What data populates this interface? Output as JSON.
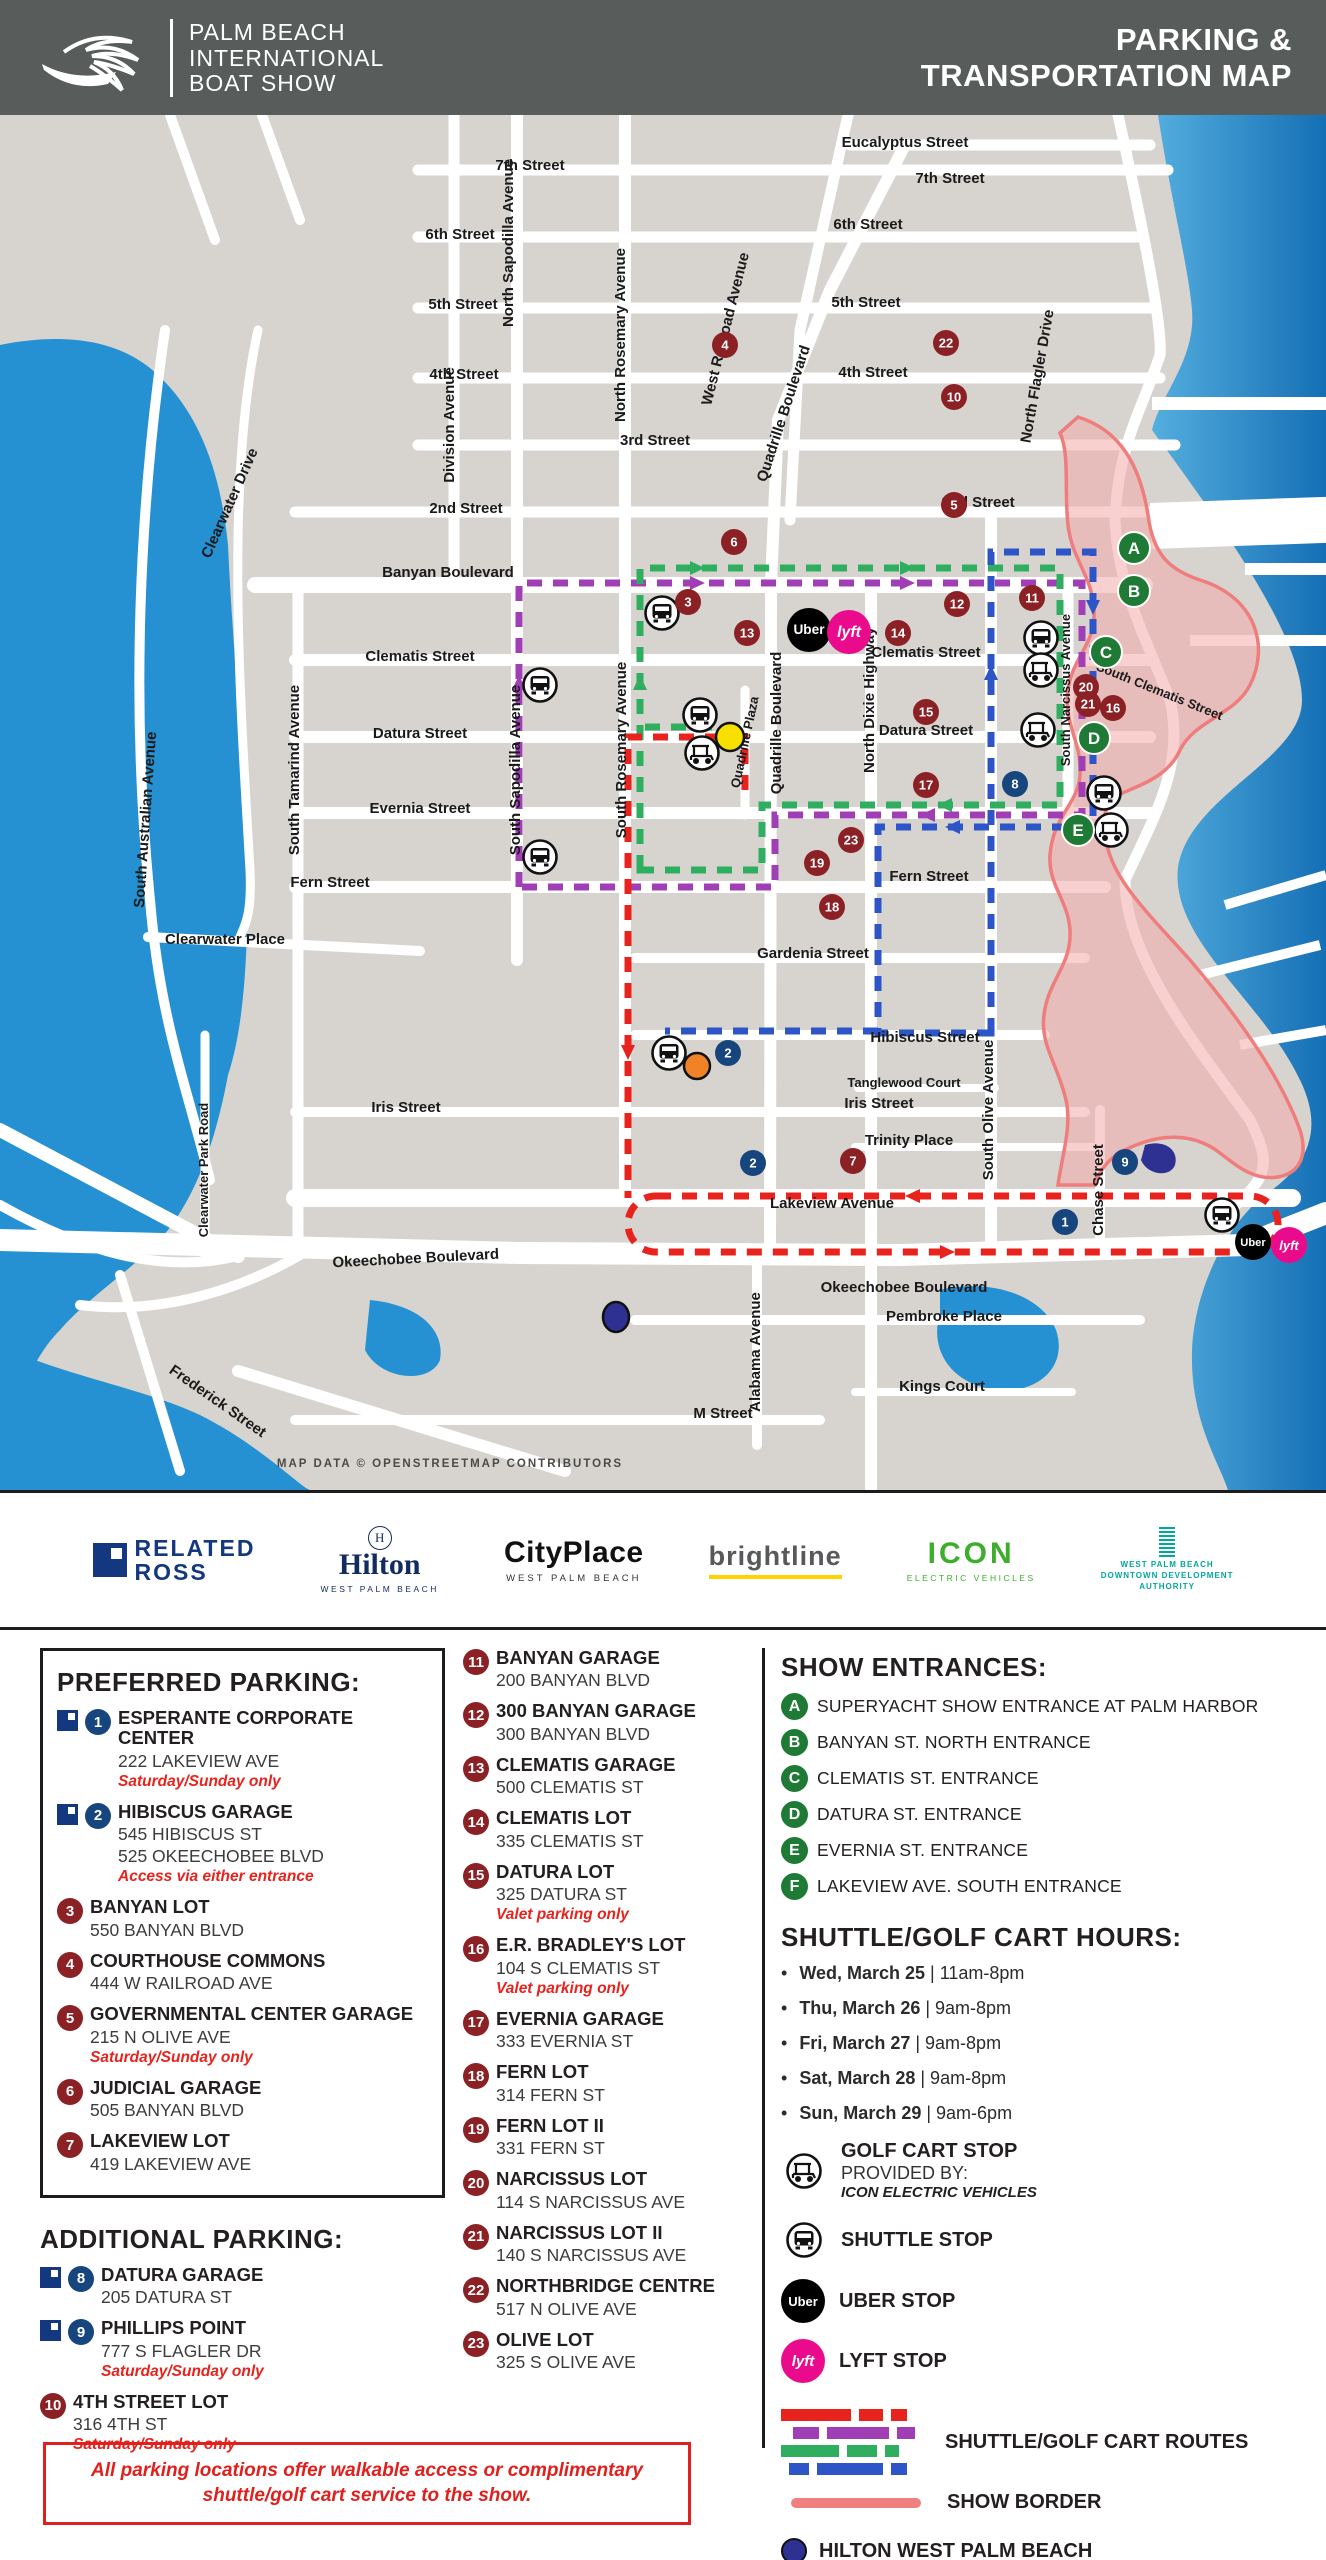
{
  "header": {
    "brand_lines": [
      "PALM BEACH",
      "INTERNATIONAL",
      "BOAT SHOW"
    ],
    "title_lines": [
      "PARKING &",
      "TRANSPORTATION MAP"
    ]
  },
  "map": {
    "attribution": "MAP DATA © OPENSTREETMAP CONTRIBUTORS",
    "street_labels": [
      {
        "t": "Eucalyptus Street",
        "x": 905,
        "y": 32
      },
      {
        "t": "7th Street",
        "x": 530,
        "y": 55
      },
      {
        "t": "7th Street",
        "x": 950,
        "y": 68
      },
      {
        "t": "6th Street",
        "x": 460,
        "y": 124
      },
      {
        "t": "6th Street",
        "x": 868,
        "y": 114
      },
      {
        "t": "5th Street",
        "x": 463,
        "y": 194
      },
      {
        "t": "5th Street",
        "x": 866,
        "y": 192
      },
      {
        "t": "4th Street",
        "x": 464,
        "y": 264
      },
      {
        "t": "4th Street",
        "x": 873,
        "y": 262
      },
      {
        "t": "3rd Street",
        "x": 655,
        "y": 330
      },
      {
        "t": "2nd Street",
        "x": 466,
        "y": 398
      },
      {
        "t": "2nd Street",
        "x": 978,
        "y": 392
      },
      {
        "t": "Banyan Boulevard",
        "x": 448,
        "y": 462
      },
      {
        "t": "Clematis Street",
        "x": 420,
        "y": 546
      },
      {
        "t": "Clematis Street",
        "x": 926,
        "y": 542
      },
      {
        "t": "Datura Street",
        "x": 420,
        "y": 623
      },
      {
        "t": "Datura Street",
        "x": 926,
        "y": 620
      },
      {
        "t": "Evernia Street",
        "x": 420,
        "y": 698
      },
      {
        "t": "Fern Street",
        "x": 330,
        "y": 772
      },
      {
        "t": "Fern Street",
        "x": 929,
        "y": 766
      },
      {
        "t": "Gardenia Street",
        "x": 813,
        "y": 843
      },
      {
        "t": "Hibiscus Street",
        "x": 925,
        "y": 927
      },
      {
        "t": "Tanglewood Court",
        "x": 904,
        "y": 972,
        "s": 13
      },
      {
        "t": "Iris Street",
        "x": 406,
        "y": 997
      },
      {
        "t": "Iris Street",
        "x": 879,
        "y": 993
      },
      {
        "t": "Trinity Place",
        "x": 909,
        "y": 1030
      },
      {
        "t": "Lakeview Avenue",
        "x": 832,
        "y": 1093
      },
      {
        "t": "Okeechobee Boulevard",
        "x": 416,
        "y": 1148,
        "r": -3
      },
      {
        "t": "Okeechobee Boulevard",
        "x": 904,
        "y": 1177
      },
      {
        "t": "Pembroke Place",
        "x": 944,
        "y": 1206
      },
      {
        "t": "Kings Court",
        "x": 942,
        "y": 1276
      },
      {
        "t": "M Street",
        "x": 723,
        "y": 1303
      },
      {
        "t": "Frederick Street",
        "x": 215,
        "y": 1290,
        "r": 35
      },
      {
        "t": "Clearwater Place",
        "x": 225,
        "y": 829
      },
      {
        "t": "North Sapodilla Avenue",
        "x": 513,
        "y": 128,
        "r": -90
      },
      {
        "t": "North Rosemary Avenue",
        "x": 625,
        "y": 220,
        "r": -90
      },
      {
        "t": "Division Avenue",
        "x": 454,
        "y": 310,
        "r": -90
      },
      {
        "t": "West Railroad Avenue",
        "x": 730,
        "y": 215,
        "r": -76
      },
      {
        "t": "Quadrille Boulevard",
        "x": 788,
        "y": 300,
        "r": -72
      },
      {
        "t": "Quadrille Boulevard",
        "x": 781,
        "y": 608,
        "r": -90
      },
      {
        "t": "Quadrille Plaza",
        "x": 749,
        "y": 628,
        "r": -78,
        "s": 13
      },
      {
        "t": "North Flagler Drive",
        "x": 1042,
        "y": 262,
        "r": -80
      },
      {
        "t": "North Dixie Highway",
        "x": 874,
        "y": 585,
        "r": -90
      },
      {
        "t": "South Olive Avenue",
        "x": 993,
        "y": 995,
        "r": -90
      },
      {
        "t": "South Narcissus Avenue",
        "x": 1070,
        "y": 575,
        "r": -90,
        "s": 13
      },
      {
        "t": "Chase Street",
        "x": 1103,
        "y": 1075,
        "r": -90
      },
      {
        "t": "Alabama Avenue",
        "x": 760,
        "y": 1237,
        "r": -90
      },
      {
        "t": "South Sapodilla Avenue",
        "x": 520,
        "y": 655,
        "r": -90
      },
      {
        "t": "South Rosemary Avenue",
        "x": 626,
        "y": 635,
        "r": -90
      },
      {
        "t": "South Tamarind Avenue",
        "x": 299,
        "y": 655,
        "r": -90
      },
      {
        "t": "South Australian Avenue",
        "x": 150,
        "y": 705,
        "r": -86
      },
      {
        "t": "Clearwater Drive",
        "x": 234,
        "y": 390,
        "r": -66
      },
      {
        "t": "Clearwater Park Road",
        "x": 208,
        "y": 1055,
        "r": -90,
        "s": 13
      },
      {
        "t": "South Clematis Street",
        "x": 1158,
        "y": 580,
        "r": 22,
        "s": 13
      }
    ],
    "parking_markers": [
      {
        "n": "1",
        "c": "blue",
        "x": 1065,
        "y": 1107
      },
      {
        "n": "2",
        "c": "blue",
        "x": 728,
        "y": 938
      },
      {
        "n": "2",
        "c": "blue",
        "x": 753,
        "y": 1048
      },
      {
        "n": "3",
        "c": "red",
        "x": 688,
        "y": 487
      },
      {
        "n": "4",
        "c": "red",
        "x": 725,
        "y": 230
      },
      {
        "n": "5",
        "c": "red",
        "x": 954,
        "y": 390
      },
      {
        "n": "6",
        "c": "red",
        "x": 734,
        "y": 427
      },
      {
        "n": "7",
        "c": "red",
        "x": 853,
        "y": 1046
      },
      {
        "n": "8",
        "c": "blue",
        "x": 1015,
        "y": 669
      },
      {
        "n": "9",
        "c": "blue",
        "x": 1125,
        "y": 1047
      },
      {
        "n": "10",
        "c": "red",
        "x": 954,
        "y": 282
      },
      {
        "n": "11",
        "c": "red",
        "x": 1032,
        "y": 483
      },
      {
        "n": "12",
        "c": "red",
        "x": 957,
        "y": 489
      },
      {
        "n": "13",
        "c": "red",
        "x": 747,
        "y": 518
      },
      {
        "n": "14",
        "c": "red",
        "x": 898,
        "y": 518
      },
      {
        "n": "15",
        "c": "red",
        "x": 926,
        "y": 597
      },
      {
        "n": "16",
        "c": "red",
        "x": 1113,
        "y": 593
      },
      {
        "n": "17",
        "c": "red",
        "x": 926,
        "y": 670
      },
      {
        "n": "18",
        "c": "red",
        "x": 832,
        "y": 792
      },
      {
        "n": "19",
        "c": "red",
        "x": 817,
        "y": 748
      },
      {
        "n": "20",
        "c": "red",
        "x": 1086,
        "y": 572
      },
      {
        "n": "21",
        "c": "red",
        "x": 1088,
        "y": 589
      },
      {
        "n": "22",
        "c": "red",
        "x": 946,
        "y": 228
      },
      {
        "n": "23",
        "c": "red",
        "x": 851,
        "y": 725
      }
    ],
    "entrance_markers": [
      {
        "l": "A",
        "x": 1134,
        "y": 433
      },
      {
        "l": "B",
        "x": 1134,
        "y": 476
      },
      {
        "l": "C",
        "x": 1106,
        "y": 537
      },
      {
        "l": "D",
        "x": 1094,
        "y": 623
      },
      {
        "l": "E",
        "x": 1078,
        "y": 715
      }
    ],
    "shuttle_stops": [
      [
        662,
        498
      ],
      [
        540,
        570
      ],
      [
        540,
        742
      ],
      [
        700,
        600
      ],
      [
        1041,
        523
      ],
      [
        1104,
        678
      ],
      [
        669,
        938
      ],
      [
        1222,
        1100
      ]
    ],
    "golfcart_stops": [
      [
        702,
        638
      ],
      [
        1041,
        555
      ],
      [
        1038,
        615
      ],
      [
        1111,
        715
      ]
    ],
    "uber_stops": [
      {
        "x": 809,
        "y": 515,
        "r": 22
      },
      {
        "x": 1253,
        "y": 1127,
        "r": 18
      }
    ],
    "lyft_stops": [
      {
        "x": 849,
        "y": 517,
        "r": 22
      },
      {
        "x": 1289,
        "y": 1130,
        "r": 18
      }
    ],
    "pois": {
      "hilton": {
        "x": 616,
        "y": 1202
      },
      "cityplace": {
        "x": 697,
        "y": 951
      },
      "brightline": {
        "x": 730,
        "y": 622
      }
    }
  },
  "sponsors": {
    "related": {
      "line1": "RELATED",
      "line2": "ROSS"
    },
    "hilton": {
      "mark": "H",
      "name": "Hilton",
      "sub": "WEST PALM BEACH"
    },
    "cityplace": {
      "name": "CityPlace",
      "sub": "WEST PALM BEACH"
    },
    "brightline": {
      "name": "brightline"
    },
    "icon": {
      "name": "ICON",
      "sub": "ELECTRIC VEHICLES"
    },
    "dda": {
      "line1": "WEST PALM BEACH",
      "line2": "DOWNTOWN DEVELOPMENT",
      "line3": "AUTHORITY"
    }
  },
  "parking": {
    "preferred_title": "PREFERRED PARKING:",
    "preferred": [
      {
        "num": "1",
        "badge": "blue",
        "rr": true,
        "name": "ESPERANTE CORPORATE CENTER",
        "addr": [
          "222 LAKEVIEW AVE"
        ],
        "note": "Saturday/Sunday only"
      },
      {
        "num": "2",
        "badge": "blue",
        "rr": true,
        "name": "HIBISCUS GARAGE",
        "addr": [
          "545 HIBISCUS ST",
          "525 OKEECHOBEE BLVD"
        ],
        "note": "Access via either entrance"
      },
      {
        "num": "3",
        "badge": "red",
        "name": "BANYAN LOT",
        "addr": [
          "550 BANYAN BLVD"
        ]
      },
      {
        "num": "4",
        "badge": "red",
        "name": "COURTHOUSE COMMONS",
        "addr": [
          "444 W RAILROAD AVE"
        ]
      },
      {
        "num": "5",
        "badge": "red",
        "name": "GOVERNMENTAL CENTER GARAGE",
        "addr": [
          "215 N OLIVE AVE"
        ],
        "note": "Saturday/Sunday only"
      },
      {
        "num": "6",
        "badge": "red",
        "name": "JUDICIAL GARAGE",
        "addr": [
          "505 BANYAN BLVD"
        ]
      },
      {
        "num": "7",
        "badge": "red",
        "name": "LAKEVIEW LOT",
        "addr": [
          "419 LAKEVIEW AVE"
        ]
      }
    ],
    "additional_title": "ADDITIONAL PARKING:",
    "additional": [
      {
        "num": "8",
        "badge": "blue",
        "rr": true,
        "name": "DATURA GARAGE",
        "addr": [
          "205 DATURA ST"
        ]
      },
      {
        "num": "9",
        "badge": "blue",
        "rr": true,
        "name": "PHILLIPS POINT",
        "addr": [
          "777 S FLAGLER DR"
        ],
        "note": "Saturday/Sunday only"
      },
      {
        "num": "10",
        "badge": "red",
        "name": "4TH STREET LOT",
        "addr": [
          "316 4TH ST"
        ],
        "note": "Saturday/Sunday only"
      }
    ],
    "column2": [
      {
        "num": "11",
        "badge": "red",
        "name": "BANYAN GARAGE",
        "addr": [
          "200 BANYAN BLVD"
        ]
      },
      {
        "num": "12",
        "badge": "red",
        "name": "300 BANYAN GARAGE",
        "addr": [
          "300 BANYAN BLVD"
        ]
      },
      {
        "num": "13",
        "badge": "red",
        "name": "CLEMATIS GARAGE",
        "addr": [
          "500 CLEMATIS ST"
        ]
      },
      {
        "num": "14",
        "badge": "red",
        "name": "CLEMATIS LOT",
        "addr": [
          "335 CLEMATIS ST"
        ]
      },
      {
        "num": "15",
        "badge": "red",
        "name": "DATURA LOT",
        "addr": [
          "325 DATURA ST"
        ],
        "note": "Valet parking only"
      },
      {
        "num": "16",
        "badge": "red",
        "name": "E.R. BRADLEY'S LOT",
        "addr": [
          "104 S CLEMATIS ST"
        ],
        "note": "Valet parking only"
      },
      {
        "num": "17",
        "badge": "red",
        "name": "EVERNIA GARAGE",
        "addr": [
          "333 EVERNIA ST"
        ]
      },
      {
        "num": "18",
        "badge": "red",
        "name": "FERN LOT",
        "addr": [
          "314 FERN ST"
        ]
      },
      {
        "num": "19",
        "badge": "red",
        "name": "FERN LOT II",
        "addr": [
          "331 FERN ST"
        ]
      },
      {
        "num": "20",
        "badge": "red",
        "name": "NARCISSUS LOT",
        "addr": [
          "114 S NARCISSUS AVE"
        ]
      },
      {
        "num": "21",
        "badge": "red",
        "name": "NARCISSUS LOT II",
        "addr": [
          "140 S NARCISSUS AVE"
        ]
      },
      {
        "num": "22",
        "badge": "red",
        "name": "NORTHBRIDGE CENTRE",
        "addr": [
          "517 N OLIVE AVE"
        ]
      },
      {
        "num": "23",
        "badge": "red",
        "name": "OLIVE LOT",
        "addr": [
          "325 S OLIVE AVE"
        ]
      }
    ]
  },
  "entrances": {
    "title": "SHOW ENTRANCES:",
    "items": [
      {
        "letter": "A",
        "label": "SUPERYACHT SHOW ENTRANCE AT PALM HARBOR"
      },
      {
        "letter": "B",
        "label": "BANYAN ST. NORTH ENTRANCE"
      },
      {
        "letter": "C",
        "label": "CLEMATIS ST. ENTRANCE"
      },
      {
        "letter": "D",
        "label": "DATURA ST. ENTRANCE"
      },
      {
        "letter": "E",
        "label": "EVERNIA ST. ENTRANCE"
      },
      {
        "letter": "F",
        "label": "LAKEVIEW AVE. SOUTH ENTRANCE"
      }
    ]
  },
  "hours": {
    "title": "SHUTTLE/GOLF CART HOURS:",
    "items": [
      {
        "day": "Wed, March 25",
        "time": "11am-8pm"
      },
      {
        "day": "Thu, March 26",
        "time": "9am-8pm"
      },
      {
        "day": "Fri, March 27",
        "time": "9am-8pm"
      },
      {
        "day": "Sat, March 28",
        "time": "9am-8pm"
      },
      {
        "day": "Sun, March 29",
        "time": "9am-6pm"
      }
    ]
  },
  "stops_legend": {
    "golfcart_line1": "GOLF CART STOP",
    "golfcart_line2": "PROVIDED BY:",
    "golfcart_line3": "ICON ELECTRIC VEHICLES",
    "shuttle": "SHUTTLE STOP",
    "uber_badge": "Uber",
    "uber": "UBER STOP",
    "lyft_badge": "lyft",
    "lyft": "LYFT STOP",
    "routes": "SHUTTLE/GOLF CART ROUTES",
    "border": "SHOW BORDER"
  },
  "pois_legend": {
    "hilton": "HILTON WEST PALM BEACH",
    "hilton_note": "Preferred VIP hotel for the show",
    "cityplace": "CITYPLACE",
    "brightline": "BRIGHTLINE STATION"
  },
  "footer_note": "All parking locations offer walkable access or complimentary shuttle/golf cart service to the show.",
  "colors": {
    "marker_red": "#8b2025",
    "marker_blue": "#17457d",
    "entrance_green": "#1e7a34",
    "route_red": "#e8231d",
    "route_purple": "#a03fb5",
    "route_green": "#2fae60",
    "route_blue": "#2d55c8",
    "border_pink": "#ef7d7d",
    "uber_black": "#000000",
    "lyft_pink": "#ea0b8c",
    "hilton_navy": "#2e3192",
    "cityplace_orange": "#f08326",
    "brightline_yellow": "#f7e000"
  }
}
